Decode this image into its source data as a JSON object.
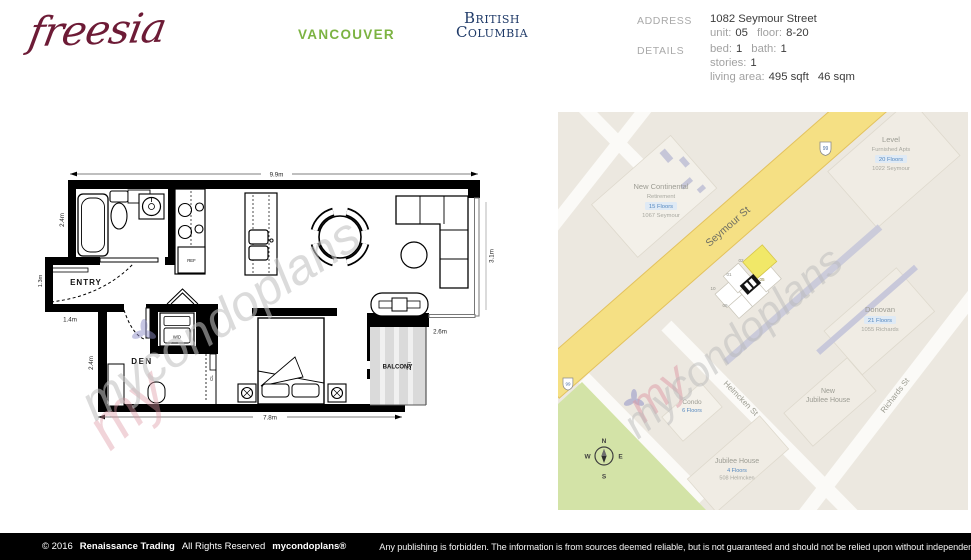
{
  "header": {
    "logo": "freesia",
    "city": "VANCOUVER",
    "province": {
      "line1": "British",
      "line2": "Columbia"
    },
    "address": {
      "label": "ADDRESS",
      "street": "1082 Seymour Street",
      "unit_label": "unit:",
      "unit": "05",
      "floor_label": "floor:",
      "floor": "8-20"
    },
    "details": {
      "label": "DETAILS",
      "bed_label": "bed:",
      "bed": "1",
      "bath_label": "bath:",
      "bath": "1",
      "stories_label": "stories:",
      "stories": "1",
      "area_label": "living area:",
      "area_sqft": "495 sqft",
      "area_sqm": "46 sqm"
    }
  },
  "floorplan": {
    "labels": {
      "entry": "ENTRY",
      "den": "DEN",
      "balcony": "BALCONY",
      "wd": "W/D",
      "ref": "REF",
      "cl": "CL"
    },
    "dims": {
      "top": "9.9m",
      "bath_left": "2.4m",
      "entry_left": "1.3m",
      "entry_bottom": "1.4m",
      "den_left": "2.4m",
      "bottom": "7.8m",
      "right": "3.1m",
      "balcony_top": "2.6m",
      "balcony_right": "2m"
    }
  },
  "map": {
    "streets": {
      "seymour": "Seymour St",
      "helmcken": "Helmcken St",
      "richards": "Richards St"
    },
    "shield": "99",
    "buildings": {
      "continental": {
        "name": "New Continental",
        "type": "Retirement",
        "floors": "15 Floors",
        "address": "1067 Seymour"
      },
      "level": {
        "name": "Level",
        "type": "Furnished Apts",
        "floors": "20 Floors",
        "address": "1022 Seymour"
      },
      "donovan": {
        "name": "Donovan",
        "floors": "21 Floors",
        "address": "1055 Richards"
      },
      "condo": {
        "name": "Condo",
        "floors": "6 Floors"
      },
      "jubilee": {
        "name": "Jubilee House",
        "floors": "4 Floors",
        "address": "508 Helmcken"
      },
      "new_jubilee": {
        "line1": "New",
        "line2": "Jubilee House"
      }
    },
    "units": {
      "u02": "02",
      "u01": "01",
      "u10": "10",
      "u09": "09",
      "u05": "05"
    },
    "highlighted_unit": "05",
    "compass": {
      "n": "N",
      "s": "S",
      "e": "E",
      "w": "W"
    }
  },
  "watermark": {
    "script": "mycondoplans",
    "overlay": "my"
  },
  "footer": {
    "copyright": "© 2016",
    "company": "Renaissance Trading",
    "rights": "All Rights Reserved",
    "brand": "mycondoplans®",
    "notice": "Any publishing is forbidden.  The information is from sources deemed reliable, but is not guaranteed and should not be relied upon without independent verification."
  },
  "colors": {
    "logo_burgundy": "#6D1B36",
    "city_green": "#7CB342",
    "province_navy": "#1F3A68",
    "road_yellow": "#F5E084",
    "park_green": "#D3E3A7",
    "unit_highlight": "#F1E868",
    "floors_blue": "#5588BF",
    "footer_black": "#000000"
  }
}
